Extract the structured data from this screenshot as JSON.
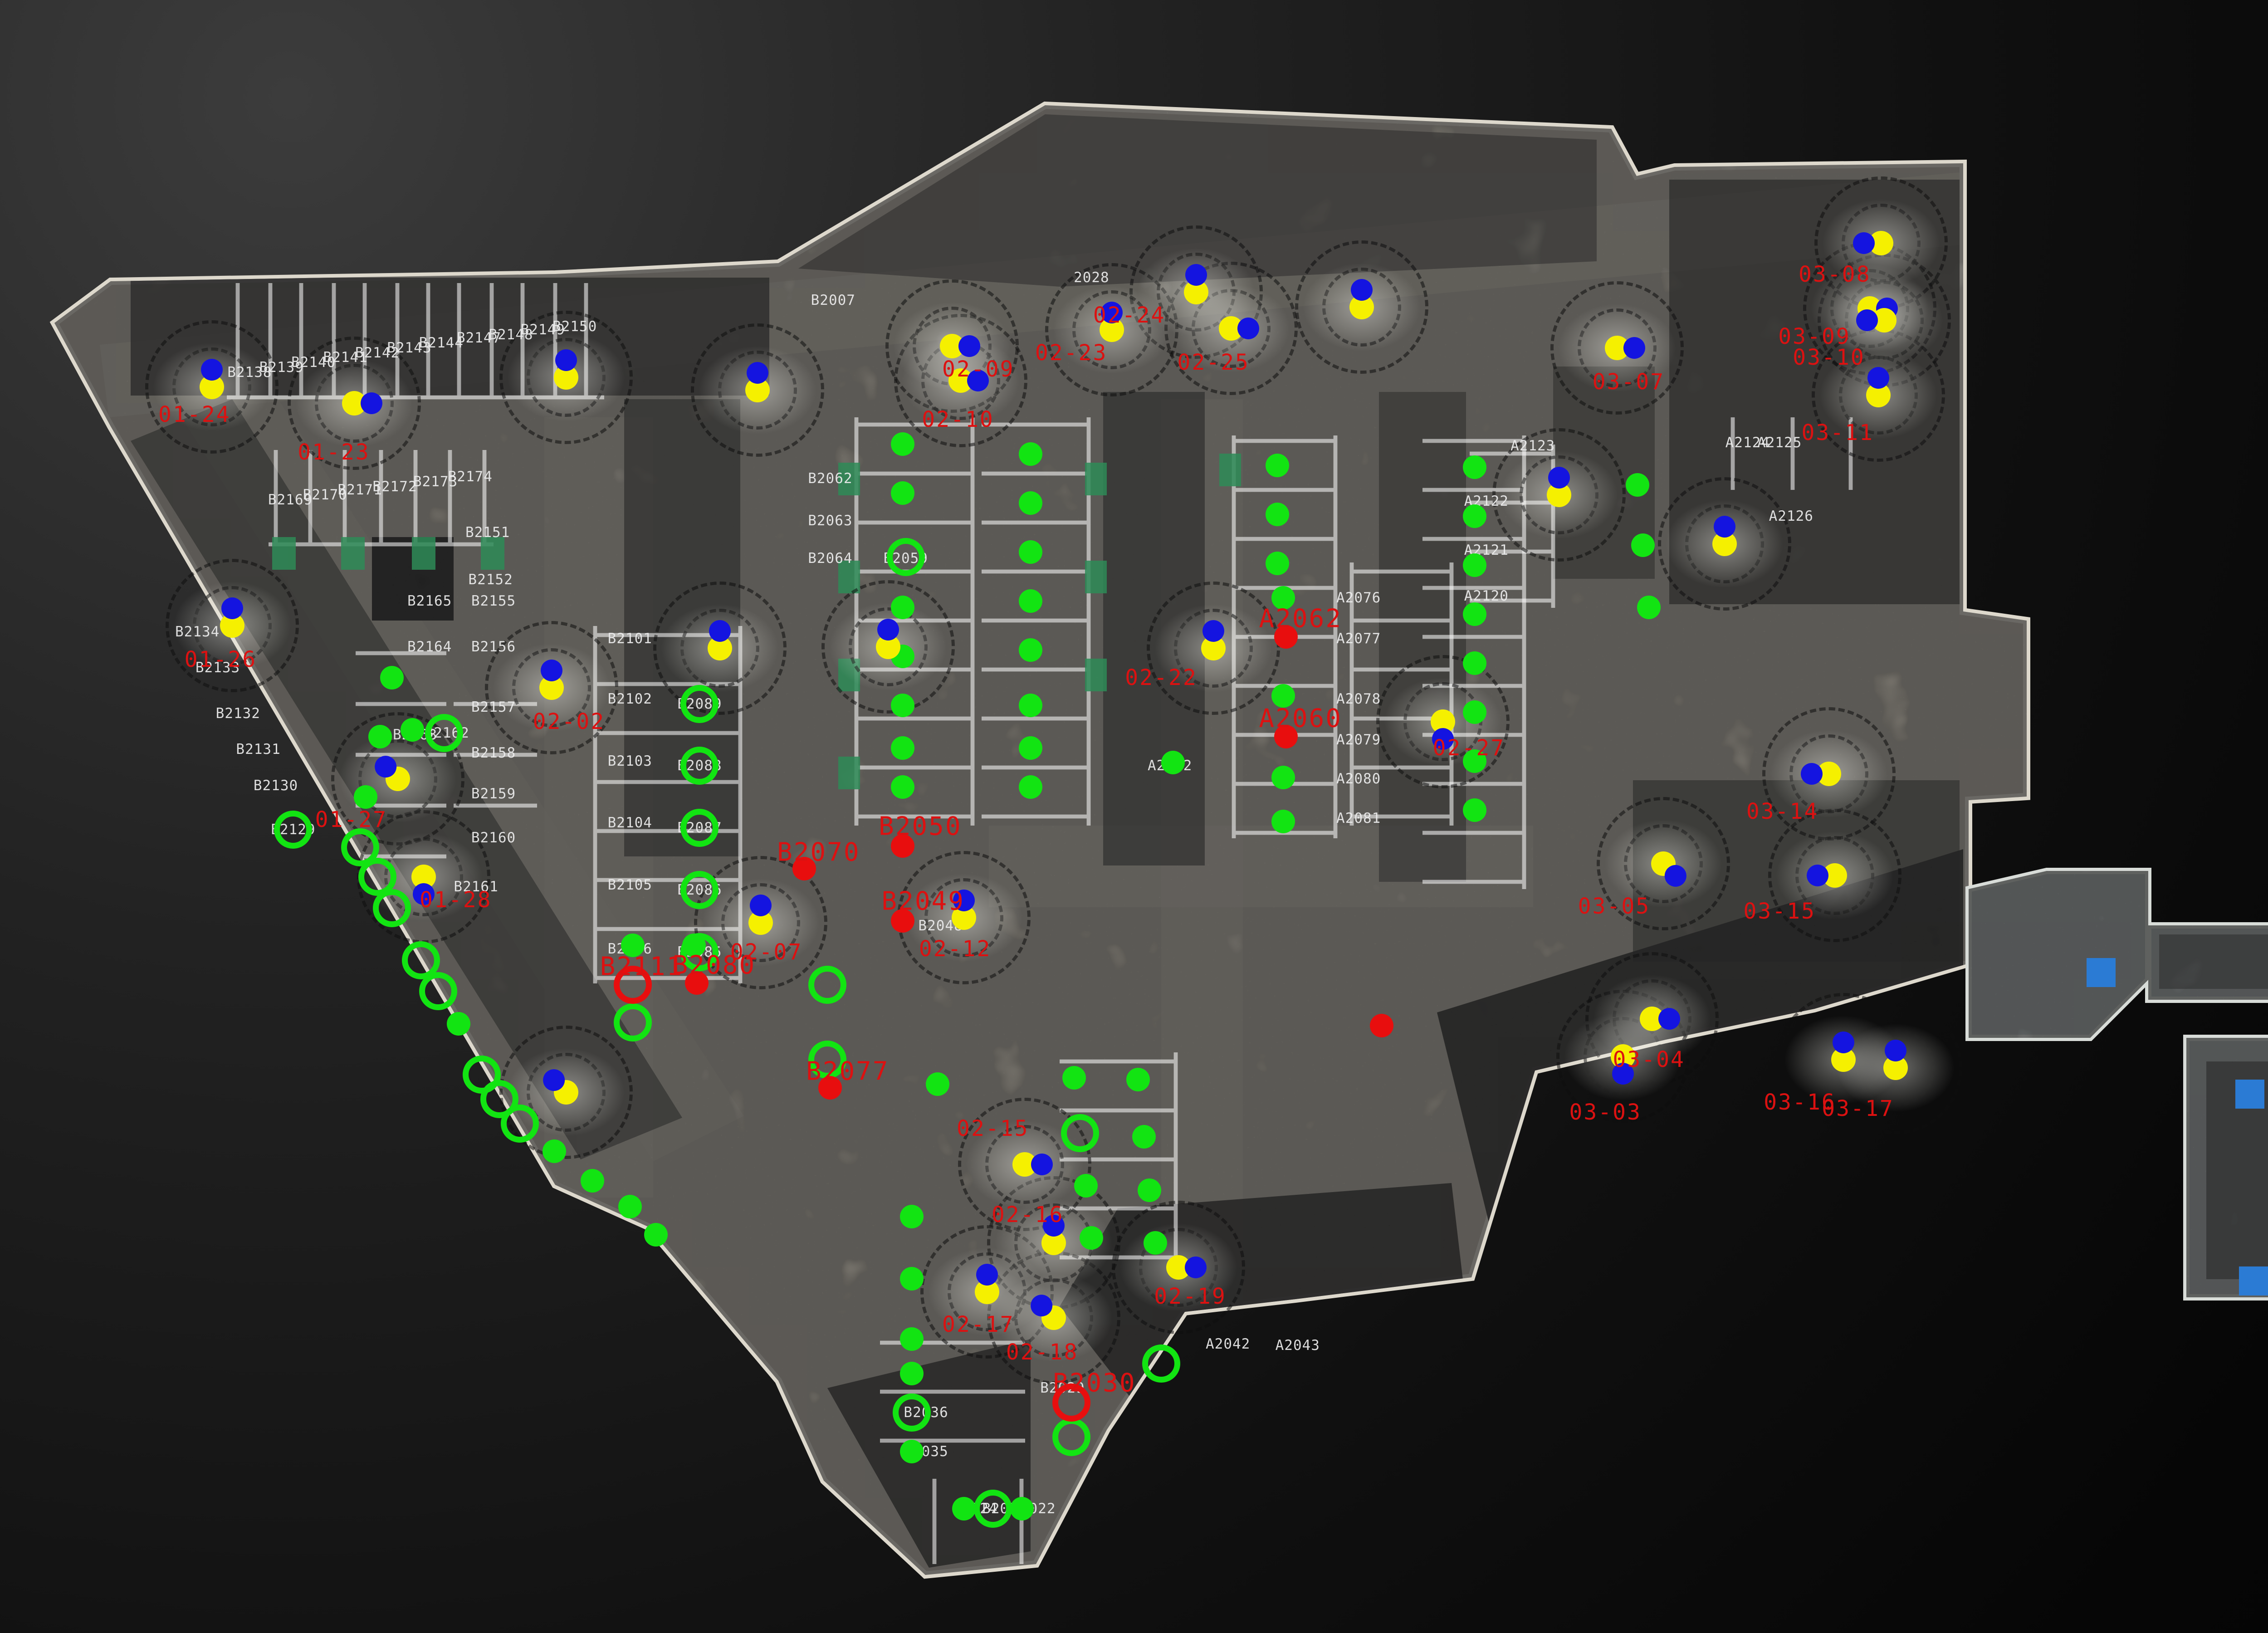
{
  "colors": {
    "background_dark": "#060606",
    "floor_light": "#b5ae9f",
    "floor_wing": "#aeb8ba",
    "wall_outline": "#ddd8cc",
    "station_yellow": "#f5f000",
    "station_blue": "#1414e0",
    "status_ok_green": "#12e412",
    "status_flag_red": "#e80e0e",
    "label_red": "#dc1111",
    "label_white": "#ededed",
    "charger_green": "#2e8b57",
    "pillar_blue": "#2b7bd4"
  },
  "stations": [
    {
      "label": "01-24",
      "x": 7.3,
      "y": 23.7,
      "ldx": -0.6,
      "ldy": 1.7,
      "ang": 0
    },
    {
      "label": "01-23",
      "x": 12.2,
      "y": 24.7,
      "ldx": -0.7,
      "ldy": 3.0,
      "ang": 90
    },
    {
      "label": "",
      "x": 19.5,
      "y": 23.1,
      "ldx": 0,
      "ldy": 0,
      "ang": 0
    },
    {
      "label": "",
      "x": 26.1,
      "y": 23.9,
      "ldx": 0,
      "ldy": 0,
      "ang": 0
    },
    {
      "label": "02-09",
      "x": 32.8,
      "y": 21.2,
      "ldx": 0.9,
      "ldy": 1.4,
      "ang": 90
    },
    {
      "label": "02-10",
      "x": 33.1,
      "y": 23.3,
      "ldx": -0.1,
      "ldy": 2.4,
      "ang": 90
    },
    {
      "label": "02-23",
      "x": 38.3,
      "y": 20.2,
      "ldx": -1.4,
      "ldy": 1.4,
      "ang": 0
    },
    {
      "label": "02-24",
      "x": 41.2,
      "y": 17.9,
      "ldx": -2.3,
      "ldy": 1.4,
      "ang": 0
    },
    {
      "label": "02-25",
      "x": 42.4,
      "y": 20.1,
      "ldx": -0.6,
      "ldy": 2.1,
      "ang": 90
    },
    {
      "label": "",
      "x": 46.9,
      "y": 18.8,
      "ldx": 0,
      "ldy": 0,
      "ang": 0
    },
    {
      "label": "03-07",
      "x": 55.7,
      "y": 21.3,
      "ldx": 0.4,
      "ldy": 2.1,
      "ang": 90
    },
    {
      "label": "",
      "x": 53.7,
      "y": 30.3,
      "ldx": 0,
      "ldy": 0,
      "ang": 0
    },
    {
      "label": "",
      "x": 59.4,
      "y": 33.3,
      "ldx": 0,
      "ldy": 0,
      "ang": 0
    },
    {
      "label": "03-08",
      "x": 64.8,
      "y": 14.9,
      "ldx": -1.6,
      "ldy": 1.9,
      "ang": 270
    },
    {
      "label": "03-09",
      "x": 64.4,
      "y": 18.9,
      "ldx": -1.9,
      "ldy": 1.7,
      "ang": 90
    },
    {
      "label": "03-10",
      "x": 64.9,
      "y": 19.6,
      "ldx": -1.9,
      "ldy": 2.3,
      "ang": 270
    },
    {
      "label": "03-11",
      "x": 64.7,
      "y": 24.2,
      "ldx": -1.4,
      "ldy": 2.3,
      "ang": 0
    },
    {
      "label": "01-26",
      "x": 8.0,
      "y": 38.3,
      "ldx": -0.4,
      "ldy": 2.1,
      "ang": 0
    },
    {
      "label": "01-27",
      "x": 13.7,
      "y": 47.7,
      "ldx": -1.6,
      "ldy": 2.5,
      "ang": 315
    },
    {
      "label": "01-28",
      "x": 14.6,
      "y": 53.7,
      "ldx": 1.1,
      "ldy": 1.4,
      "ang": 180
    },
    {
      "label": "",
      "x": 19.5,
      "y": 66.9,
      "ldx": 0,
      "ldy": 0,
      "ang": 315
    },
    {
      "label": "02-02",
      "x": 19.0,
      "y": 42.1,
      "ldx": 0.6,
      "ldy": 2.1,
      "ang": 0
    },
    {
      "label": "02-07",
      "x": 26.2,
      "y": 56.5,
      "ldx": 0.2,
      "ldy": 1.8,
      "ang": 0
    },
    {
      "label": "02-22",
      "x": 41.8,
      "y": 39.7,
      "ldx": -1.8,
      "ldy": 1.8,
      "ang": 0
    },
    {
      "label": "02-27",
      "x": 49.7,
      "y": 44.2,
      "ldx": 0.9,
      "ldy": 1.6,
      "ang": 180
    },
    {
      "label": "02-12",
      "x": 33.2,
      "y": 56.2,
      "ldx": -0.3,
      "ldy": 1.9,
      "ang": 0
    },
    {
      "label": "02-15",
      "x": 35.3,
      "y": 71.3,
      "ldx": -1.1,
      "ldy": -2.2,
      "ang": 90
    },
    {
      "label": "02-16",
      "x": 36.3,
      "y": 76.1,
      "ldx": -0.9,
      "ldy": -1.7,
      "ang": 0
    },
    {
      "label": "02-17",
      "x": 34.0,
      "y": 79.1,
      "ldx": -0.3,
      "ldy": 2.0,
      "ang": 0
    },
    {
      "label": "02-18",
      "x": 36.3,
      "y": 80.7,
      "ldx": -0.4,
      "ldy": 2.1,
      "ang": 315
    },
    {
      "label": "02-19",
      "x": 40.6,
      "y": 77.6,
      "ldx": 0.4,
      "ldy": 1.8,
      "ang": 90
    },
    {
      "label": "03-05",
      "x": 57.3,
      "y": 52.9,
      "ldx": -1.7,
      "ldy": 2.6,
      "ang": 135
    },
    {
      "label": "03-14",
      "x": 63.0,
      "y": 47.4,
      "ldx": -1.6,
      "ldy": 2.3,
      "ang": 270
    },
    {
      "label": "03-15",
      "x": 63.2,
      "y": 53.6,
      "ldx": -1.9,
      "ldy": 2.2,
      "ang": 270
    },
    {
      "label": "03-04",
      "x": 55.9,
      "y": 64.7,
      "ldx": 0.9,
      "ldy": 0.2,
      "ang": 180
    },
    {
      "label": "",
      "x": 56.9,
      "y": 62.4,
      "ldx": 0,
      "ldy": 0,
      "ang": 90
    },
    {
      "label": "03-16",
      "x": 63.5,
      "y": 64.9,
      "ldx": -1.5,
      "ldy": 2.6,
      "ang": 0
    },
    {
      "label": "03-17",
      "x": 65.3,
      "y": 65.4,
      "ldx": -1.3,
      "ldy": 2.5,
      "ang": 0
    },
    {
      "label": "",
      "x": 24.8,
      "y": 39.7,
      "ldx": 0,
      "ldy": 0,
      "ang": 0
    },
    {
      "label": "",
      "x": 30.6,
      "y": 39.6,
      "ldx": 0,
      "ldy": 0,
      "ang": 0
    }
  ],
  "free_red_labels": [
    {
      "text": "03-03",
      "x": 55.3,
      "y": 68.1
    }
  ],
  "markers": {
    "green_dots": [
      [
        13.5,
        41.5
      ],
      [
        13.1,
        45.1
      ],
      [
        12.6,
        48.8
      ],
      [
        14.2,
        44.7
      ],
      [
        15.8,
        62.7
      ],
      [
        19.1,
        70.5
      ],
      [
        20.4,
        72.3
      ],
      [
        21.7,
        73.9
      ],
      [
        22.6,
        75.6
      ],
      [
        31.1,
        27.2
      ],
      [
        31.1,
        30.2
      ],
      [
        31.1,
        37.2
      ],
      [
        31.1,
        40.2
      ],
      [
        31.1,
        43.2
      ],
      [
        31.1,
        45.8
      ],
      [
        31.1,
        48.2
      ],
      [
        31.4,
        74.5
      ],
      [
        31.4,
        78.3
      ],
      [
        31.4,
        82.0
      ],
      [
        31.4,
        84.1
      ],
      [
        31.4,
        88.9
      ],
      [
        33.2,
        92.4
      ],
      [
        35.2,
        92.4
      ],
      [
        35.5,
        27.8
      ],
      [
        35.5,
        30.8
      ],
      [
        35.5,
        33.8
      ],
      [
        35.5,
        36.8
      ],
      [
        35.5,
        39.8
      ],
      [
        35.5,
        43.2
      ],
      [
        35.5,
        45.8
      ],
      [
        35.5,
        48.2
      ],
      [
        37.0,
        66.0
      ],
      [
        37.4,
        72.6
      ],
      [
        37.6,
        75.8
      ],
      [
        32.3,
        66.4
      ],
      [
        39.2,
        66.1
      ],
      [
        39.4,
        69.6
      ],
      [
        39.6,
        72.9
      ],
      [
        39.8,
        76.1
      ],
      [
        44.0,
        28.5
      ],
      [
        44.0,
        31.5
      ],
      [
        44.0,
        34.5
      ],
      [
        44.2,
        36.6
      ],
      [
        44.2,
        42.6
      ],
      [
        44.2,
        47.6
      ],
      [
        44.2,
        50.3
      ],
      [
        40.4,
        46.7
      ],
      [
        50.8,
        28.6
      ],
      [
        50.8,
        31.6
      ],
      [
        50.8,
        34.6
      ],
      [
        50.8,
        37.6
      ],
      [
        50.8,
        40.6
      ],
      [
        50.8,
        43.6
      ],
      [
        50.8,
        46.6
      ],
      [
        50.8,
        49.6
      ],
      [
        56.4,
        29.7
      ],
      [
        56.6,
        33.4
      ],
      [
        56.8,
        37.2
      ],
      [
        21.8,
        57.9
      ],
      [
        23.9,
        57.9
      ]
    ],
    "green_rings": [
      [
        15.3,
        44.9
      ],
      [
        10.1,
        50.8
      ],
      [
        12.4,
        51.9
      ],
      [
        13.0,
        53.7
      ],
      [
        13.5,
        55.6
      ],
      [
        14.5,
        58.8
      ],
      [
        15.1,
        60.7
      ],
      [
        16.6,
        65.8
      ],
      [
        17.2,
        67.3
      ],
      [
        17.9,
        68.8
      ],
      [
        31.2,
        34.1
      ],
      [
        28.5,
        60.3
      ],
      [
        28.5,
        64.9
      ],
      [
        21.8,
        62.6
      ],
      [
        24.1,
        43.1
      ],
      [
        24.1,
        46.9
      ],
      [
        24.1,
        50.7
      ],
      [
        24.1,
        54.5
      ],
      [
        24.1,
        58.3
      ],
      [
        37.2,
        69.4
      ],
      [
        40.0,
        83.5
      ],
      [
        31.4,
        86.5
      ],
      [
        34.2,
        92.4
      ],
      [
        36.9,
        88.0
      ]
    ],
    "red_dots": [
      {
        "x": 31.1,
        "y": 51.8,
        "label": "B2050",
        "lx": 31.7,
        "ly": 50.6
      },
      {
        "x": 31.1,
        "y": 56.4,
        "label": "B2049",
        "lx": 31.8,
        "ly": 55.2
      },
      {
        "x": 27.7,
        "y": 53.2,
        "label": "B2070",
        "lx": 28.2,
        "ly": 52.2
      },
      {
        "x": 24.0,
        "y": 60.2,
        "label": "B2080",
        "lx": 24.6,
        "ly": 59.1
      },
      {
        "x": 44.3,
        "y": 39.0,
        "label": "A2062",
        "lx": 44.8,
        "ly": 37.9
      },
      {
        "x": 44.3,
        "y": 45.1,
        "label": "A2060",
        "lx": 44.8,
        "ly": 44.0
      },
      {
        "x": 28.6,
        "y": 66.6,
        "label": "B2077",
        "lx": 29.2,
        "ly": 65.6
      },
      {
        "x": 47.6,
        "y": 62.8,
        "label": "",
        "lx": 0,
        "ly": 0
      }
    ],
    "red_rings": [
      {
        "x": 21.8,
        "y": 60.3,
        "label": "B2111",
        "lx": 22.1,
        "ly": 59.2
      },
      {
        "x": 36.9,
        "y": 85.9,
        "label": "B2030",
        "lx": 37.7,
        "ly": 84.7
      }
    ]
  },
  "space_labels": [
    {
      "t": "B2138",
      "x": 8.6,
      "y": 22.8
    },
    {
      "t": "B2139",
      "x": 9.7,
      "y": 22.5
    },
    {
      "t": "B2140",
      "x": 10.8,
      "y": 22.2
    },
    {
      "t": "B2141",
      "x": 11.9,
      "y": 21.9
    },
    {
      "t": "B2142",
      "x": 13.0,
      "y": 21.6
    },
    {
      "t": "B2143",
      "x": 14.1,
      "y": 21.3
    },
    {
      "t": "B2144",
      "x": 15.2,
      "y": 21.0
    },
    {
      "t": "B2147",
      "x": 16.5,
      "y": 20.7
    },
    {
      "t": "B2148",
      "x": 17.6,
      "y": 20.5
    },
    {
      "t": "B2149",
      "x": 18.7,
      "y": 20.2
    },
    {
      "t": "B2150",
      "x": 19.8,
      "y": 20.0
    },
    {
      "t": "B2169",
      "x": 10.0,
      "y": 30.6
    },
    {
      "t": "B2170",
      "x": 11.2,
      "y": 30.3
    },
    {
      "t": "B2171",
      "x": 12.4,
      "y": 30.0
    },
    {
      "t": "B2172",
      "x": 13.6,
      "y": 29.8
    },
    {
      "t": "B2173",
      "x": 15.0,
      "y": 29.5
    },
    {
      "t": "B2174",
      "x": 16.2,
      "y": 29.2
    },
    {
      "t": "B2151",
      "x": 16.8,
      "y": 32.6
    },
    {
      "t": "B2152",
      "x": 16.9,
      "y": 35.5
    },
    {
      "t": "B2165",
      "x": 14.8,
      "y": 36.8
    },
    {
      "t": "B2155",
      "x": 17.0,
      "y": 36.8
    },
    {
      "t": "B2164",
      "x": 14.8,
      "y": 39.6
    },
    {
      "t": "B2156",
      "x": 17.0,
      "y": 39.6
    },
    {
      "t": "B2157",
      "x": 17.0,
      "y": 43.3
    },
    {
      "t": "B2158",
      "x": 17.0,
      "y": 46.1
    },
    {
      "t": "B2159",
      "x": 17.0,
      "y": 48.6
    },
    {
      "t": "B2160",
      "x": 17.0,
      "y": 51.3
    },
    {
      "t": "B2161",
      "x": 16.4,
      "y": 54.3
    },
    {
      "t": "B2134",
      "x": 6.8,
      "y": 38.7
    },
    {
      "t": "B2133",
      "x": 7.5,
      "y": 40.9
    },
    {
      "t": "B2132",
      "x": 8.2,
      "y": 43.7
    },
    {
      "t": "B2131",
      "x": 8.9,
      "y": 45.9
    },
    {
      "t": "B2130",
      "x": 9.5,
      "y": 48.1
    },
    {
      "t": "B2129",
      "x": 10.1,
      "y": 50.8
    },
    {
      "t": "B2163",
      "x": 14.3,
      "y": 45.0
    },
    {
      "t": "B2162",
      "x": 15.4,
      "y": 44.9
    },
    {
      "t": "B2101",
      "x": 21.7,
      "y": 39.1
    },
    {
      "t": "B2102",
      "x": 21.7,
      "y": 42.8
    },
    {
      "t": "B2103",
      "x": 21.7,
      "y": 46.6
    },
    {
      "t": "B2104",
      "x": 21.7,
      "y": 50.4
    },
    {
      "t": "B2105",
      "x": 21.7,
      "y": 54.2
    },
    {
      "t": "B2106",
      "x": 21.7,
      "y": 58.1
    },
    {
      "t": "B2089",
      "x": 24.1,
      "y": 43.1
    },
    {
      "t": "B2088",
      "x": 24.1,
      "y": 46.9
    },
    {
      "t": "B2087",
      "x": 24.1,
      "y": 50.7
    },
    {
      "t": "B2086",
      "x": 24.1,
      "y": 54.5
    },
    {
      "t": "B2085",
      "x": 24.1,
      "y": 58.3
    },
    {
      "t": "B2007",
      "x": 28.7,
      "y": 18.4
    },
    {
      "t": "2028",
      "x": 37.6,
      "y": 17.0
    },
    {
      "t": "B2062",
      "x": 28.6,
      "y": 29.3
    },
    {
      "t": "B2063",
      "x": 28.6,
      "y": 31.9
    },
    {
      "t": "B2064",
      "x": 28.6,
      "y": 34.2
    },
    {
      "t": "B2059",
      "x": 31.2,
      "y": 34.2
    },
    {
      "t": "B2048",
      "x": 32.4,
      "y": 56.7
    },
    {
      "t": "B2029",
      "x": 36.6,
      "y": 85.0
    },
    {
      "t": "B2036",
      "x": 31.9,
      "y": 86.5
    },
    {
      "t": "B2035",
      "x": 31.9,
      "y": 88.9
    },
    {
      "t": "B2024",
      "x": 33.6,
      "y": 92.4
    },
    {
      "t": "B2023",
      "x": 34.6,
      "y": 92.4
    },
    {
      "t": "B2022",
      "x": 35.6,
      "y": 92.4
    },
    {
      "t": "A2076",
      "x": 46.8,
      "y": 36.6
    },
    {
      "t": "A2077",
      "x": 46.8,
      "y": 39.1
    },
    {
      "t": "A2078",
      "x": 46.8,
      "y": 42.8
    },
    {
      "t": "A2079",
      "x": 46.8,
      "y": 45.3
    },
    {
      "t": "A2080",
      "x": 46.8,
      "y": 47.7
    },
    {
      "t": "A2081",
      "x": 46.8,
      "y": 50.1
    },
    {
      "t": "A2042",
      "x": 42.3,
      "y": 82.3
    },
    {
      "t": "A2043",
      "x": 44.7,
      "y": 82.4
    },
    {
      "t": "A2052",
      "x": 40.3,
      "y": 46.9
    },
    {
      "t": "A2120",
      "x": 51.2,
      "y": 36.5
    },
    {
      "t": "A2121",
      "x": 51.2,
      "y": 33.7
    },
    {
      "t": "A2122",
      "x": 51.2,
      "y": 30.7
    },
    {
      "t": "A2123",
      "x": 52.8,
      "y": 27.3
    },
    {
      "t": "A2124",
      "x": 60.2,
      "y": 27.1
    },
    {
      "t": "A2125",
      "x": 61.3,
      "y": 27.1
    },
    {
      "t": "A2126",
      "x": 61.7,
      "y": 31.6
    }
  ]
}
